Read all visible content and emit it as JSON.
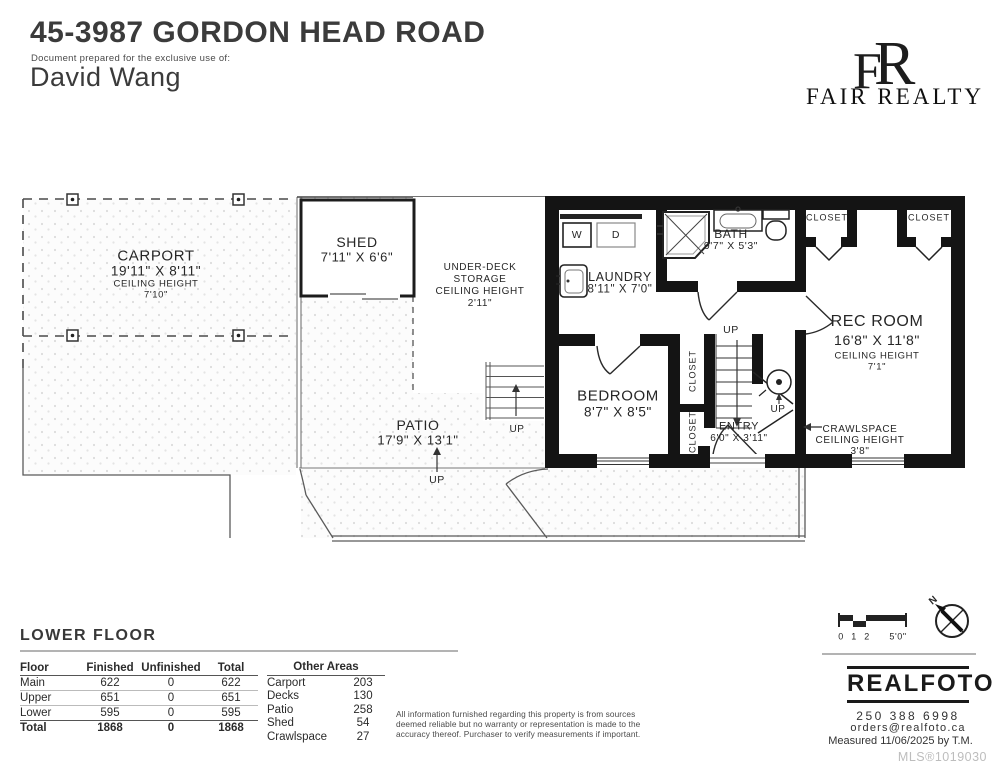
{
  "header": {
    "address": "45-3987 GORDON HEAD ROAD",
    "prepared_for": "Document prepared for the exclusive use of:",
    "client": "David Wang",
    "brand_monogram_f": "F",
    "brand_monogram_r": "R",
    "brand": "FAIR REALTY"
  },
  "plan": {
    "carport": {
      "name": "CARPORT",
      "dims": "19'11\" X 8'11\"",
      "ceiling_label": "CEILING HEIGHT",
      "ceiling": "7'10\""
    },
    "shed": {
      "name": "SHED",
      "dims": "7'11\" X 6'6\""
    },
    "under_deck": {
      "line1": "UNDER-DECK",
      "line2": "STORAGE",
      "line3": "CEILING HEIGHT",
      "line4": "2'11\""
    },
    "laundry": {
      "name": "LAUNDRY",
      "dims": "8'11\" X 7'0\""
    },
    "bath": {
      "name": "BATH",
      "dims": "9'7\" X 5'3\""
    },
    "bedroom": {
      "name": "BEDROOM",
      "dims": "8'7\" X 8'5\""
    },
    "rec_room": {
      "name": "REC ROOM",
      "dims": "16'8\" X 11'8\"",
      "ceiling_label": "CEILING HEIGHT",
      "ceiling": "7'1\""
    },
    "entry": {
      "name": "ENTRY",
      "dims": "6'0\" X 3'11\""
    },
    "patio": {
      "name": "PATIO",
      "dims": "17'9\" X 13'1\""
    },
    "crawlspace": {
      "line1": "CRAWLSPACE",
      "line2": "CEILING HEIGHT",
      "line3": "3'8\""
    },
    "closet_label": "CLOSET",
    "up_label": "UP",
    "washer_label": "W",
    "dryer_label": "D",
    "north_label": "N"
  },
  "scale_bar": {
    "t0": "0",
    "t1": "1",
    "t2": "2",
    "t5": "5'0\""
  },
  "footer": {
    "floor_label": "LOWER FLOOR",
    "area_table": {
      "col_floor": "Floor",
      "col_finished": "Finished",
      "col_unfinished": "Unfinished",
      "col_total": "Total",
      "rows": [
        {
          "name": "Main",
          "finished": "622",
          "unfinished": "0",
          "total": "622"
        },
        {
          "name": "Upper",
          "finished": "651",
          "unfinished": "0",
          "total": "651"
        },
        {
          "name": "Lower",
          "finished": "595",
          "unfinished": "0",
          "total": "595"
        },
        {
          "name": "Total",
          "finished": "1868",
          "unfinished": "0",
          "total": "1868"
        }
      ]
    },
    "other_areas": {
      "title": "Other Areas",
      "rows": [
        {
          "name": "Carport",
          "value": "203"
        },
        {
          "name": "Decks",
          "value": "130"
        },
        {
          "name": "Patio",
          "value": "258"
        },
        {
          "name": "Shed",
          "value": "54"
        },
        {
          "name": "Crawlspace",
          "value": "27"
        }
      ]
    },
    "disclaimer": "All information furnished regarding this property is from sources deemed reliable but no warranty or representation is made to the accuracy thereof. Purchaser to verify measurements if important.",
    "realfoto": {
      "logo": "REALFOTO",
      "phone": "250 388 6998",
      "email": "orders@realfoto.ca",
      "measured": "Measured  11/06/2025 by T.M.",
      "mls": "MLS®1019030"
    }
  },
  "colors": {
    "wall": "#141414",
    "text": "#2b2b2b",
    "rule_gray": "#9a9a9a",
    "mls_gray": "#bdbdbd"
  }
}
